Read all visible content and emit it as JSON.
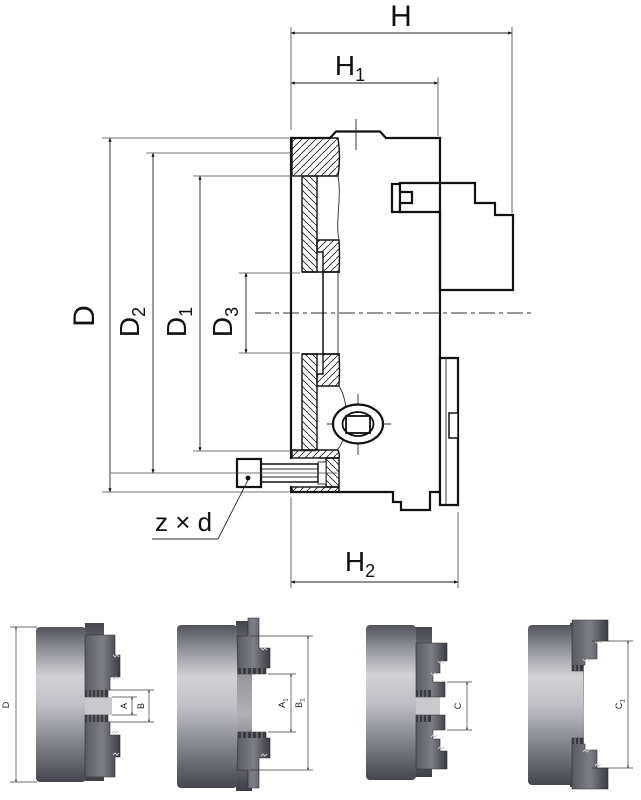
{
  "colors": {
    "line": "#111111",
    "background": "#ffffff",
    "body_gray_light": "#cbcbcf",
    "body_gray_dark": "#4e4e55",
    "jaw_gray_dark": "#3f3f47"
  },
  "dims": {
    "H": {
      "base": "H",
      "sub": ""
    },
    "H1": {
      "base": "H",
      "sub": "1"
    },
    "H2": {
      "base": "H",
      "sub": "2"
    },
    "D": {
      "base": "D",
      "sub": ""
    },
    "D2": {
      "base": "D",
      "sub": "2"
    },
    "D1": {
      "base": "D",
      "sub": "1"
    },
    "D3": {
      "base": "D",
      "sub": "3"
    },
    "zxd": {
      "base": "z × d",
      "sub": ""
    },
    "Dv": {
      "base": "D",
      "sub": ""
    },
    "A": {
      "base": "A",
      "sub": ""
    },
    "B": {
      "base": "B",
      "sub": ""
    },
    "A1": {
      "base": "A",
      "sub": "1"
    },
    "B1": {
      "base": "B",
      "sub": "1"
    },
    "C": {
      "base": "C",
      "sub": ""
    },
    "C1": {
      "base": "C",
      "sub": "1"
    }
  },
  "views": {
    "main": {
      "dimension_ids": [
        "H",
        "H1",
        "D",
        "D2",
        "D1",
        "D3",
        "zxd",
        "H2"
      ]
    },
    "bottom": [
      {
        "id": "view-1",
        "dimension_ids": [
          "Dv",
          "A",
          "B"
        ]
      },
      {
        "id": "view-2",
        "dimension_ids": [
          "A1",
          "B1"
        ]
      },
      {
        "id": "view-3",
        "dimension_ids": [
          "C"
        ]
      },
      {
        "id": "view-4",
        "dimension_ids": [
          "C1"
        ]
      }
    ]
  }
}
